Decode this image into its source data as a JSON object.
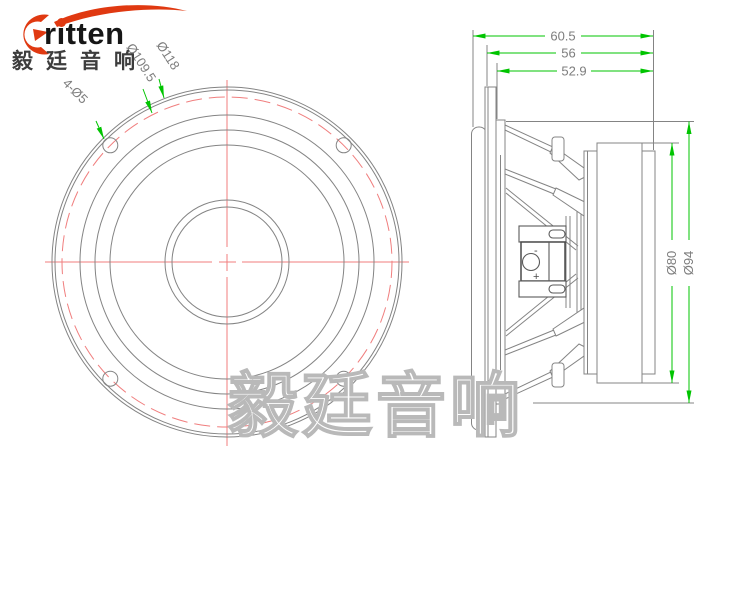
{
  "logo": {
    "brand": "ritten",
    "chinese": "毅廷音响"
  },
  "watermark": {
    "text": "毅廷音响"
  },
  "front_view": {
    "callouts": {
      "mounting_holes": "4-Ø5",
      "bolt_circle": "Ø109.5",
      "outer": "Ø118"
    }
  },
  "side_view": {
    "dims": {
      "overall_depth": "60.5",
      "frame_depth": "56",
      "mounting_depth": "52.9",
      "magnet_diameter": "Ø80",
      "frame_diameter": "Ø94"
    },
    "terminal": {
      "plus": "+",
      "minus": "-"
    }
  },
  "colors": {
    "dimension_green": "#00c400",
    "centerline_red": "#f07e7e",
    "line_gray": "#848484",
    "text_gray": "#7d7d7d",
    "logo_red": "#e03911",
    "logo_ink": "#161616",
    "logo_cn": "#3d3d3d",
    "watermark_gray": "#b9b9b9"
  }
}
